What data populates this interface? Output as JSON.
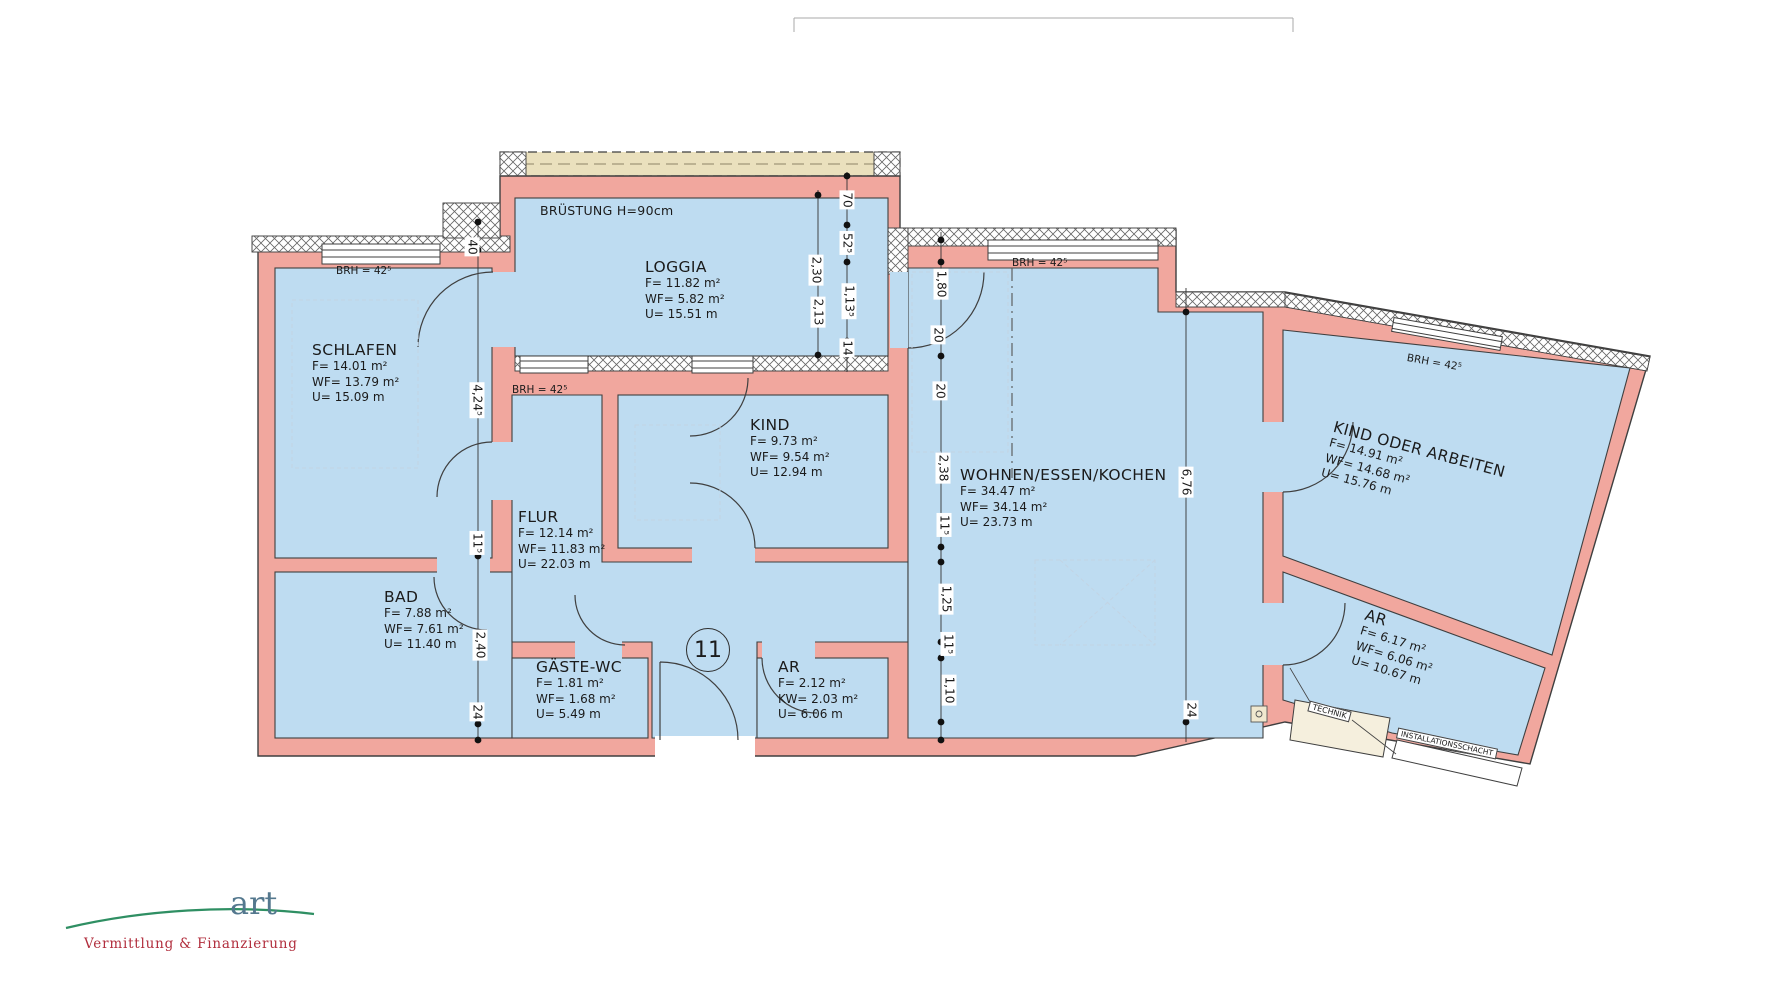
{
  "plan_notes": {
    "parapet": "BRÜSTUNG H=90cm",
    "unit_number": "11"
  },
  "rooms": [
    {
      "id": "schlafen",
      "name": "SCHLAFEN",
      "f": "F= 14.01 m²",
      "wf": "WF= 13.79 m²",
      "u": "U= 15.09 m"
    },
    {
      "id": "loggia",
      "name": "LOGGIA",
      "f": "F= 11.82 m²",
      "wf": "WF= 5.82 m²",
      "u": "U= 15.51 m"
    },
    {
      "id": "kind",
      "name": "KIND",
      "f": "F= 9.73 m²",
      "wf": "WF= 9.54 m²",
      "u": "U= 12.94 m"
    },
    {
      "id": "flur",
      "name": "FLUR",
      "f": "F= 12.14 m²",
      "wf": "WF= 11.83 m²",
      "u": "U= 22.03 m"
    },
    {
      "id": "bad",
      "name": "BAD",
      "f": "F= 7.88 m²",
      "wf": "WF= 7.61 m²",
      "u": "U= 11.40 m"
    },
    {
      "id": "gaeste-wc",
      "name": "GÄSTE-WC",
      "f": "F= 1.81 m²",
      "wf": "WF= 1.68 m²",
      "u": "U= 5.49 m"
    },
    {
      "id": "ar-klein",
      "name": "AR",
      "f": "F= 2.12 m²",
      "wf": "KW= 2.03 m²",
      "u": "U= 6.06 m"
    },
    {
      "id": "wohnen",
      "name": "WOHNEN/ESSEN/KOCHEN",
      "f": "F= 34.47 m²",
      "wf": "WF= 34.14 m²",
      "u": "U= 23.73 m"
    },
    {
      "id": "kind-oder-arbeiten",
      "name": "KIND ODER ARBEITEN",
      "f": "F= 14.91 m²",
      "wf": "WF= 14.68 m²",
      "u": "U= 15.76 m"
    },
    {
      "id": "ar-rechts",
      "name": "AR",
      "f": "F= 6.17 m²",
      "wf": "WF= 6.06 m²",
      "u": "U= 10.67 m"
    }
  ],
  "service_labels": {
    "technik": "TECHNIK",
    "schacht": "INSTALLATIONSSCHACHT"
  },
  "brh": {
    "schlafen": "BRH = 42⁵",
    "flur": "BRH = 42⁵",
    "wohnen": "BRH = 42⁵",
    "wing": "BRH = 42⁵"
  },
  "dims": {
    "d40": "40",
    "d424": "4,24⁵",
    "d115a": "11⁵",
    "d240": "2,40",
    "d24l": "24",
    "d230": "2,30",
    "d213": "2,13",
    "d70": "70",
    "d525": "52⁵",
    "d1135": "1,13⁵",
    "d14": "14",
    "d180": "1,80",
    "d20a": "20",
    "d20b": "20",
    "d238": "2,38",
    "d115b": "11⁵",
    "d125": "1,25",
    "d115c": "11⁵",
    "d110": "1,10",
    "d676": "6,76",
    "d24r": "24"
  },
  "logo": {
    "word": "art",
    "tagline": "Vermittlung & Finanzierung"
  },
  "colors": {
    "wall": "#f1a79e",
    "room": "#bedcf1",
    "beige": "#eae0bd",
    "logo_green": "#2f8f63",
    "logo_red": "#b12e3d",
    "logo_blue": "#54788e"
  }
}
